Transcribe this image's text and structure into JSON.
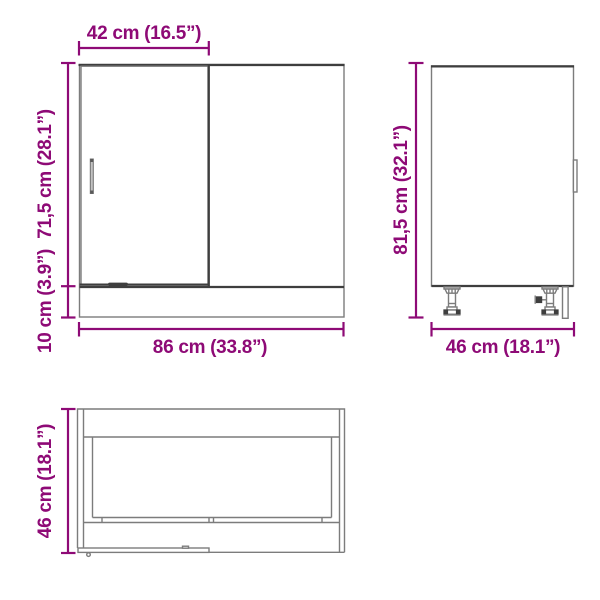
{
  "drawing": {
    "accent_color": "#8E0A76",
    "line_color": "#7c7c7c",
    "dark_line_color": "#3e3e3e",
    "background_color": "#ffffff",
    "views": {
      "front": {
        "name": "cabinet-front-view",
        "door_width_label": "42 cm (16.5”)",
        "door_height_label": "71,5 cm (28.1”)",
        "plinth_height_label": "10 cm (3.9”)",
        "total_width_label": "86 cm (33.8”)"
      },
      "side": {
        "name": "cabinet-side-view",
        "total_height_label": "81,5 cm (32.1”)",
        "depth_label": "46 cm (18.1”)"
      },
      "top": {
        "name": "cabinet-top-view",
        "depth_label": "46 cm (18.1”)"
      }
    }
  }
}
